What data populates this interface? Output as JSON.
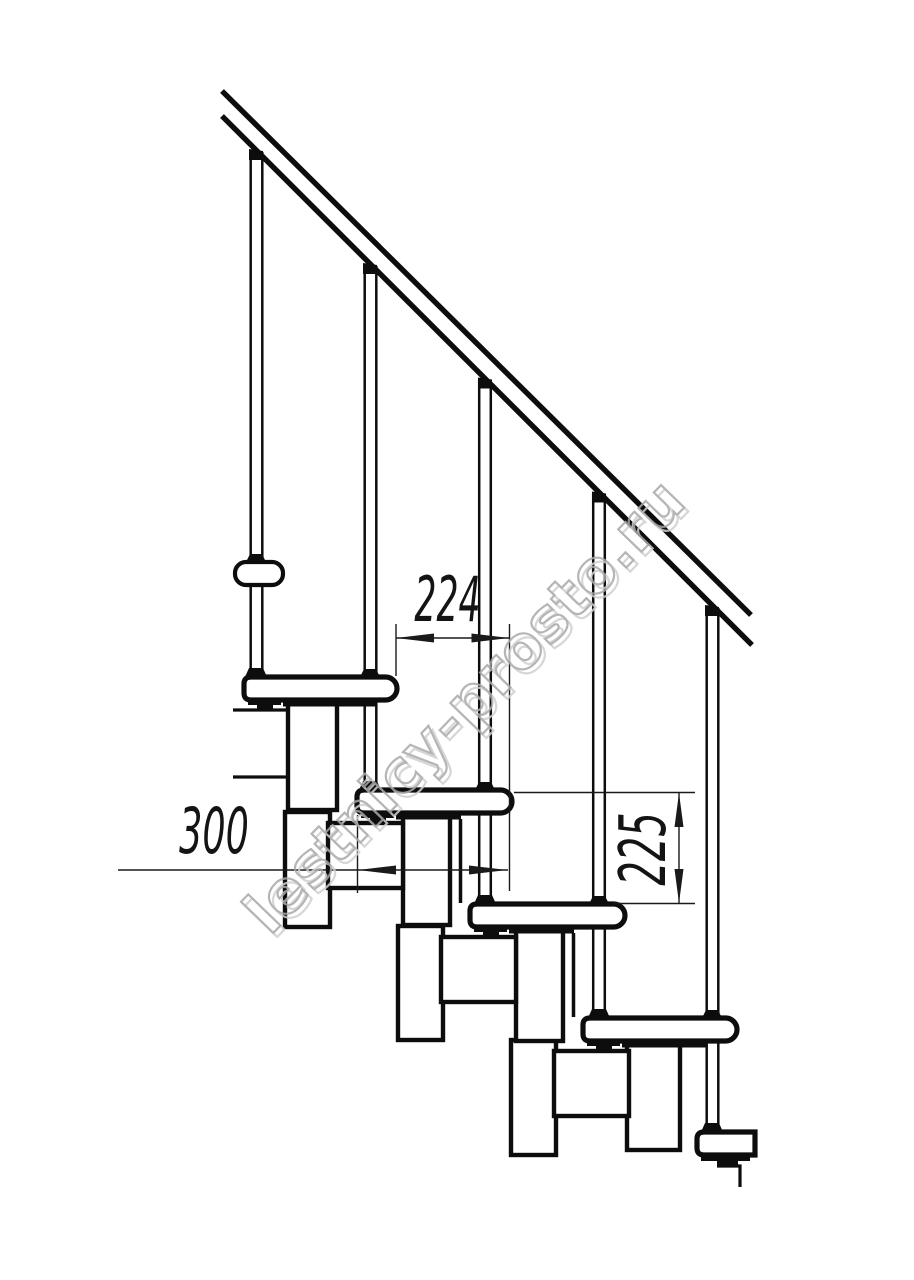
{
  "drawing": {
    "kind": "staircase-side-elevation",
    "background": "#ffffff",
    "line_color": "#0d0d0d",
    "dimension_color": "#1a1a1a",
    "watermark": {
      "text": "lestnicy-prosto.ru",
      "outline_color": "#a9a9a9",
      "shadow_color": "#d0d0d0"
    },
    "dimensions": {
      "going": {
        "value": "224",
        "orientation": "horizontal"
      },
      "tread_depth": {
        "value": "300",
        "orientation": "horizontal"
      },
      "rise": {
        "value": "225",
        "orientation": "vertical"
      }
    },
    "structure": {
      "treads": 5,
      "balusters": 5,
      "handrail_lines": 2
    }
  }
}
